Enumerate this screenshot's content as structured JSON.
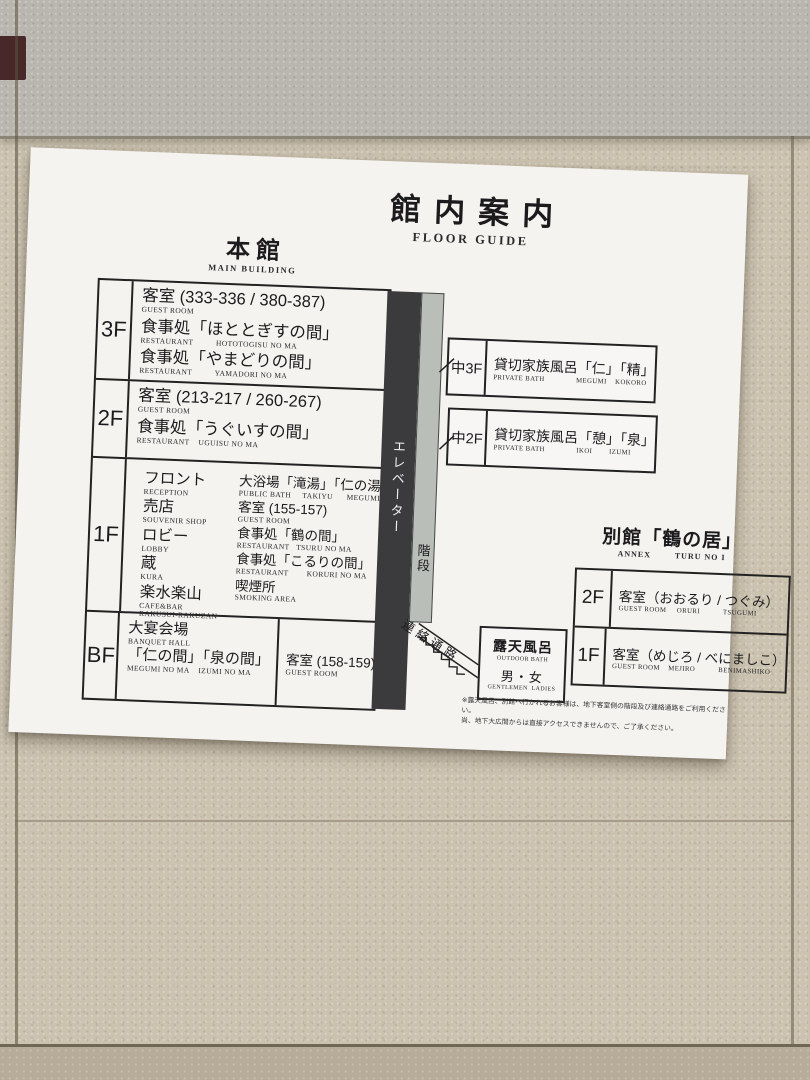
{
  "title": {
    "ja": "館内案内",
    "en": "FLOOR GUIDE"
  },
  "main": {
    "heading_ja": "本館",
    "heading_en": "MAIN BUILDING",
    "f3": {
      "label": "3F",
      "items": [
        {
          "ja": "客室 (333-336 / 380-387)",
          "en": "GUEST ROOM"
        },
        {
          "ja": "食事処「ほととぎすの間」",
          "en": "RESTAURANT          HOTOTOGISU NO MA"
        },
        {
          "ja": "食事処「やまどりの間」",
          "en": "RESTAURANT          YAMADORI NO MA"
        }
      ]
    },
    "f2": {
      "label": "2F",
      "items": [
        {
          "ja": "客室 (213-217 / 260-267)",
          "en": "GUEST ROOM"
        },
        {
          "ja": "食事処「うぐいすの間」",
          "en": "RESTAURANT    UGUISU NO MA"
        }
      ]
    },
    "f1": {
      "label": "1F",
      "left": [
        {
          "ja": "フロント",
          "en": "RECEPTION"
        },
        {
          "ja": "売店",
          "en": "SOUVENIR SHOP"
        },
        {
          "ja": "ロビー",
          "en": "LOBBY"
        },
        {
          "ja": "蔵",
          "en": "KURA"
        },
        {
          "ja": "楽水楽山",
          "en": "CAFE&BAR\nRAKUSUI-RAKUZAN"
        }
      ],
      "right": [
        {
          "ja": "大浴場「滝湯」「仁の湯」",
          "en": "PUBLIC BATH     TAKIYU      MEGUMI NO YU"
        },
        {
          "ja": "客室 (155-157)",
          "en": "GUEST ROOM"
        },
        {
          "ja": "食事処「鶴の間」",
          "en": "RESTAURANT   TSURU NO MA"
        },
        {
          "ja": "食事処「こるりの間」",
          "en": "RESTAURANT        KORURI NO MA"
        },
        {
          "ja": "喫煙所",
          "en": "SMOKING AREA"
        }
      ]
    },
    "bf": {
      "label": "BF",
      "hall_ja1": "大宴会場",
      "hall_en1": "BANQUET HALL",
      "hall_ja2": "「仁の間」「泉の間」",
      "hall_en2": "MEGUMI NO MA    IZUMI NO MA",
      "guest_ja": "客室 (158-159)",
      "guest_en": "GUEST ROOM"
    }
  },
  "mid": {
    "m3": {
      "label": "中3F",
      "ja": "貸切家族風呂「仁」「精」",
      "en": "PRIVATE BATH               MEGUMI    KOKORO"
    },
    "m2": {
      "label": "中2F",
      "ja": "貸切家族風呂「憩」「泉」",
      "en": "PRIVATE BATH               IKOI        IZUMI"
    }
  },
  "circulation": {
    "elevator": "エレベーター",
    "stairs": "階段",
    "corridor": "連絡通路"
  },
  "outdoor_bath": {
    "ja": "露天風呂",
    "en": "OUTDOOR BATH",
    "genders_ja": "男・女",
    "genders_en": "GENTLEMEN  LADIES"
  },
  "annex": {
    "heading_ja": "別館「鶴の居」",
    "heading_en": "ANNEX        TURU NO I",
    "f2": {
      "label": "2F",
      "ja": "客室（おおるり / つぐみ）",
      "en": "GUEST ROOM     ORURI           TSUGUMI"
    },
    "f1": {
      "label": "1F",
      "ja": "客室（めじろ / べにましこ）",
      "en": "GUEST ROOM    MEJIRO           BENIMASHIKO"
    }
  },
  "note": {
    "line1": "※露天風呂、別館へ行かれるお客様は、地下客室側の階段及び連絡通路をご利用ください。",
    "line2": "尚、地下大広間からは直接アクセスできませんので、ご了承ください。"
  },
  "colors": {
    "paper": "#f4f3f0",
    "ink": "#1b1b1d",
    "elevator_bar": "#3b3b3e",
    "stairs_bar": "#b9beb8",
    "wall": "#cbc2af",
    "wall_top": "#b9b6b0"
  }
}
